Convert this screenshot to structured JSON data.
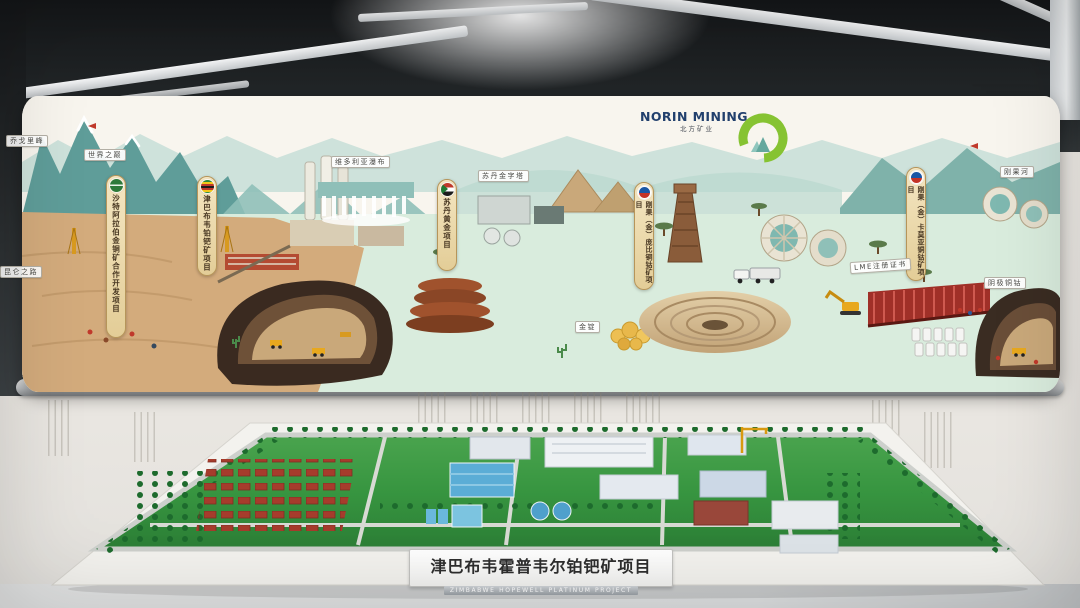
{
  "exhibit": {
    "brand": {
      "name": "NORIN MINING",
      "name_cn": "北方矿业"
    },
    "screen": {
      "banners": [
        {
          "id": "saudi",
          "flag": "saudi-arabia-flag",
          "label": "沙特阿拉伯金铜矿合作开发项目"
        },
        {
          "id": "zimbabwe",
          "flag": "zimbabwe-flag",
          "label": "津巴布韦铂钯矿项目"
        },
        {
          "id": "sudan",
          "flag": "sudan-flag",
          "label": "苏丹黄金项目"
        },
        {
          "id": "drc-pumpi",
          "flag": "company-roundel",
          "label": "刚果（金）庞比铜钴矿项目"
        },
        {
          "id": "drc-kamoya",
          "flag": "company-roundel",
          "label": "刚果（金）卡莫亚铜钴矿项目"
        }
      ],
      "place_labels": {
        "peak": "乔戈里峰",
        "world_summit": "世界之巅",
        "kunlun_road": "昆仑之路",
        "victoria_falls": "维多利亚瀑布",
        "sudan_pyramids": "苏丹金字塔",
        "congo_river": "刚果河",
        "lme_certificate": "LME注册证书",
        "gold_ingot": "金锭",
        "cathode_copper": "阴极铜钴"
      }
    },
    "model": {
      "nameplate_cn": "津巴布韦霍普韦尔铂钯矿项目",
      "nameplate_en": "ZIMBABWE HOPEWELL PLATINUM PROJECT"
    },
    "colors": {
      "accent_green": "#8dc63f",
      "brand_navy": "#22406d",
      "banner_tan": "#ecd9ac",
      "panorama_teal": "#5f9d99",
      "desert_tan": "#d3ab7c",
      "model_grass": "#2f9240",
      "pool_blue": "#5badd6",
      "roof_red": "#a63c2c"
    }
  }
}
